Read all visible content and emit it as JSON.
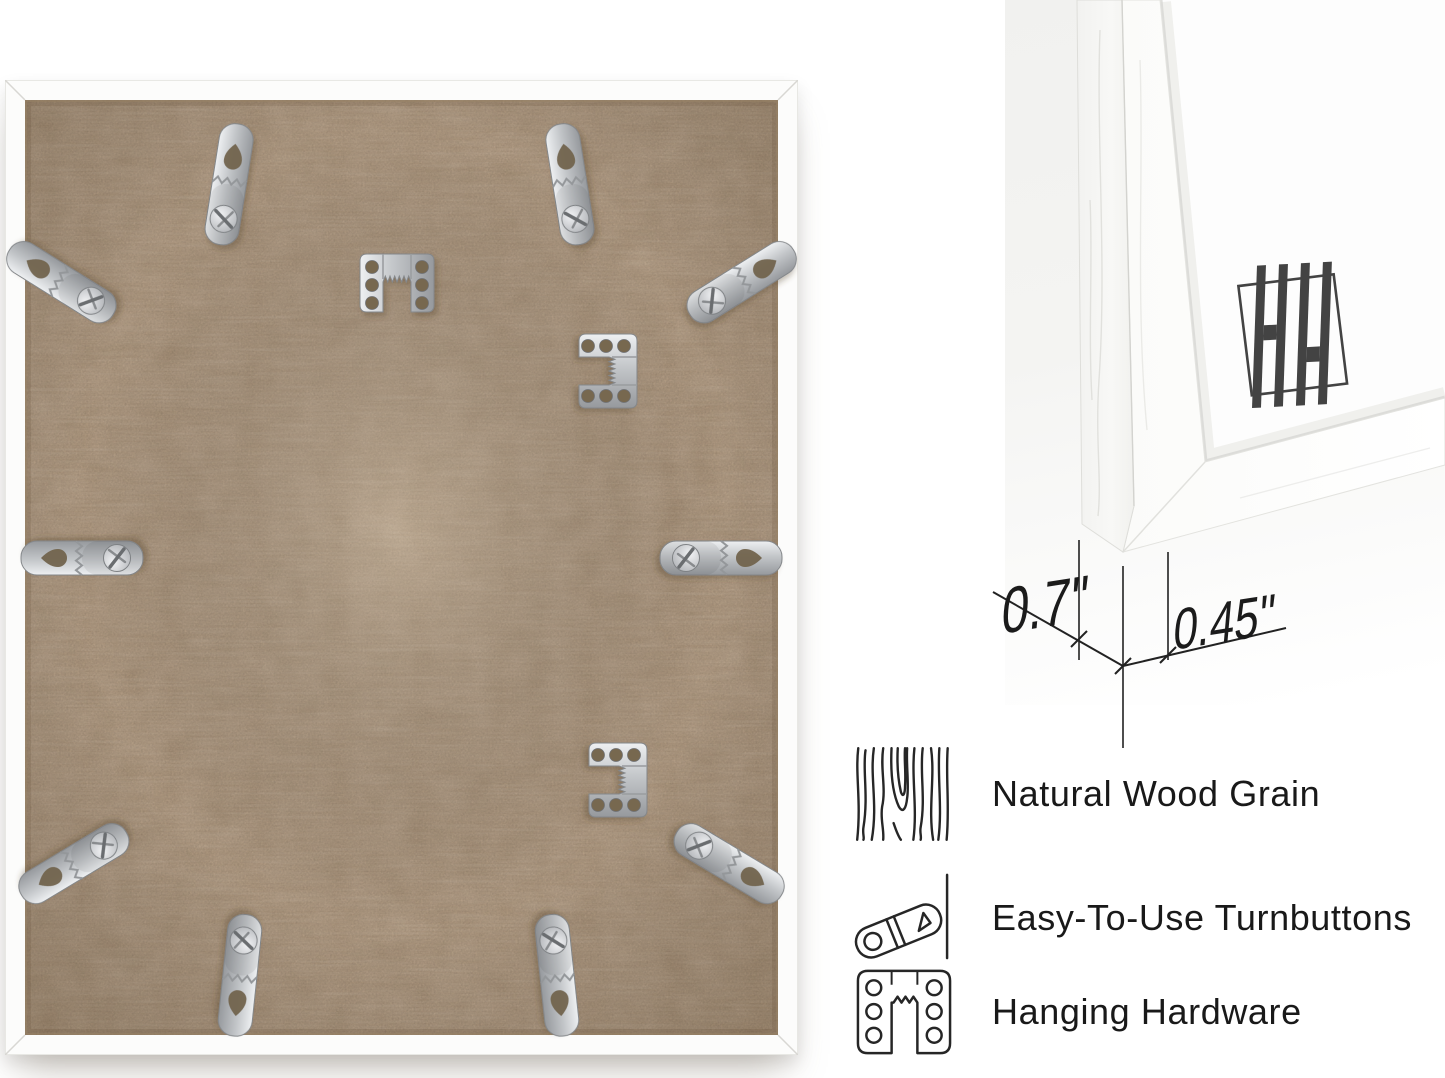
{
  "page": {
    "background": "#ffffff",
    "description": "picture frame product image: back view with hardware, corner detail with dimensions, feature callouts"
  },
  "left_photo": {
    "name": "frame-back-view",
    "frame_color": "#fcfcfb",
    "board_color": "#c9b197",
    "metal_color": "#b9bcbf",
    "turnbuttons": [
      {
        "x": 233,
        "y": 48,
        "r": 9
      },
      {
        "x": 556,
        "y": 48,
        "r": -9
      },
      {
        "x": 8,
        "y": 172,
        "r": -58
      },
      {
        "x": 785,
        "y": 172,
        "r": 58
      },
      {
        "x": 20,
        "y": 478,
        "r": -90
      },
      {
        "x": 773,
        "y": 478,
        "r": 90
      },
      {
        "x": 20,
        "y": 813,
        "r": -121
      },
      {
        "x": 773,
        "y": 813,
        "r": 121
      },
      {
        "x": 229,
        "y": 952,
        "r": 186
      },
      {
        "x": 558,
        "y": 952,
        "r": 174
      }
    ],
    "hangers": [
      {
        "x": 392,
        "y": 203,
        "r": 0
      },
      {
        "x": 603,
        "y": 291,
        "r": 90
      },
      {
        "x": 613,
        "y": 700,
        "r": 90
      }
    ]
  },
  "right_photo": {
    "name": "frame-corner-detail",
    "brand_monogram": "HH",
    "measurements": {
      "depth_label": "0.7\"",
      "face_label": "0.45\""
    }
  },
  "features": [
    {
      "icon": "wood-grain-icon",
      "label": "Natural Wood Grain"
    },
    {
      "icon": "turnbutton-icon",
      "label": "Easy-To-Use Turnbuttons"
    },
    {
      "icon": "hanging-hardware-icon",
      "label": "Hanging Hardware"
    }
  ],
  "colors": {
    "text": "#191919",
    "icon_stroke": "#262626",
    "logo": "#434343",
    "dimension_lines": "#222222",
    "board_tan": "#c9b197",
    "metal_silver": "#b9bcbf",
    "frame_white": "#fcfcfb"
  }
}
